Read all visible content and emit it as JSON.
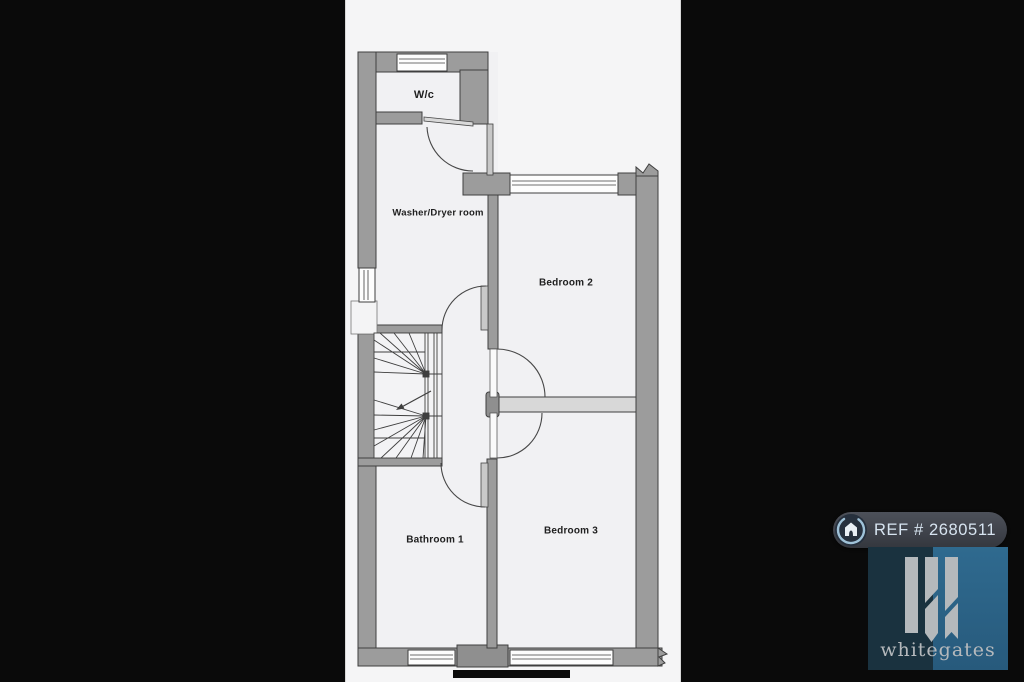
{
  "plan": {
    "title": "First floor plan",
    "rooms": [
      {
        "id": "wc",
        "label": "W/c"
      },
      {
        "id": "washer_dryer",
        "label": "Washer/Dryer room"
      },
      {
        "id": "bedroom2",
        "label": "Bedroom 2"
      },
      {
        "id": "bathroom1",
        "label": "Bathroom 1"
      },
      {
        "id": "bedroom3",
        "label": "Bedroom 3"
      }
    ],
    "features": [
      "winder-staircase",
      "5 windows",
      "5 door-swings",
      "wall-break-marks",
      "scale-bar"
    ]
  },
  "watermark": {
    "ref_label": "REF # 2680511",
    "brand": "whitegates"
  },
  "icons": {
    "badge_icon": "house-in-circle",
    "logo_mark": "whitegates-monogram"
  },
  "colors": {
    "side_bars": "#0a0a0a",
    "page_bg": "#f5f5f6",
    "wall_fill": "#9c9c9c",
    "wall_outline": "#3f3f3f",
    "badge_bg": "#3e424a",
    "badge_text": "#d7e4f0",
    "badge_ring": "#9fc2d8",
    "logo_left": "#1a323f",
    "logo_right": "#2d6488",
    "logo_foreground": "#b5b9bc",
    "scale_bar": "#0c0c0c"
  }
}
